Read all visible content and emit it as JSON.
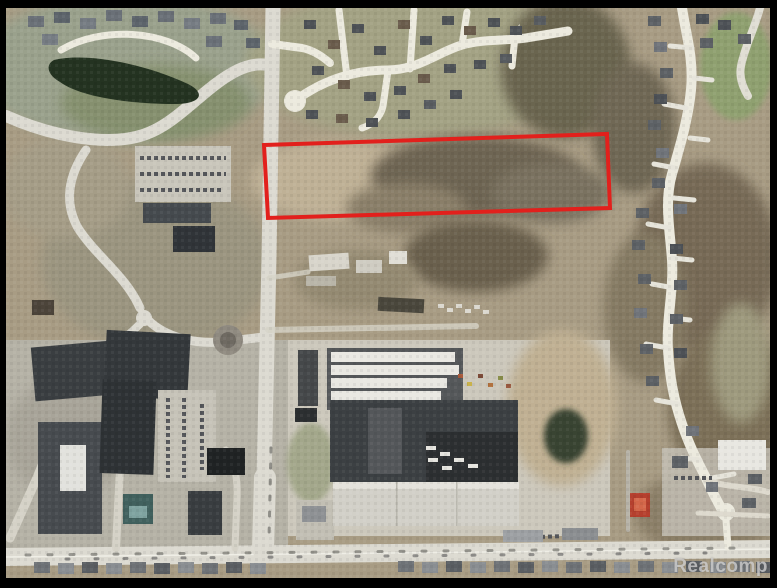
{
  "watermark": {
    "label": "Realcomp"
  },
  "parcel": {
    "points": "258,137 601,126 604,200 262,210",
    "description": "red-outlined land parcel"
  },
  "colors": {
    "border": "#000000",
    "parcel_outline": "#e2201c",
    "watermark": "#cdcdcd",
    "road": "#dcdad1",
    "street_bright": "#eceade",
    "terrain_base": "#a89c84",
    "pond": "#243321",
    "roof_dark": "#3c4043",
    "roof_white": "#e9e8e2",
    "roof_red": "#b5402e",
    "roof_teal": "#41615e"
  }
}
